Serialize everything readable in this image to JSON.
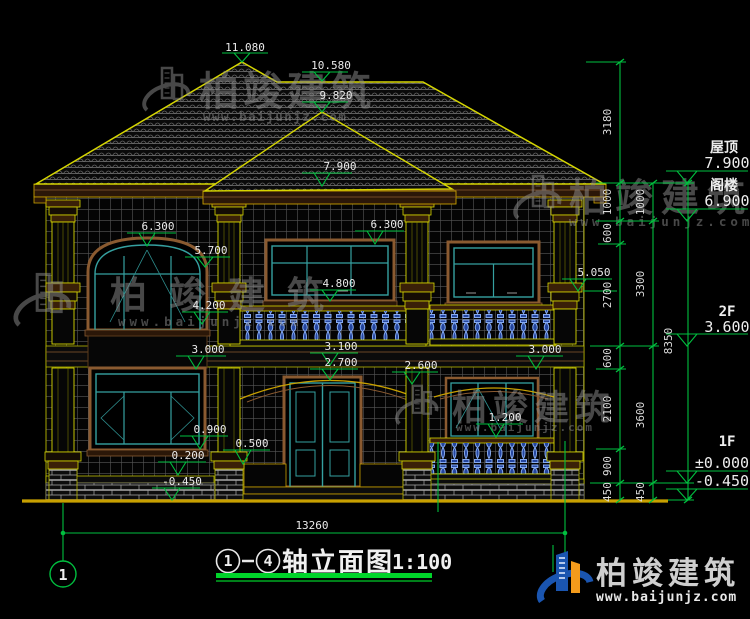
{
  "drawing": {
    "title": {
      "axis_start": "1",
      "axis_end": "4",
      "name": "轴立面图",
      "scale": "1:100"
    },
    "axis": {
      "left_bubble": "1"
    },
    "overall_width_dim": "13260",
    "elevation_markers": [
      "11.080",
      "10.580",
      "9.820",
      "7.900",
      "6.300",
      "5.700",
      "6.300",
      "4.800",
      "4.200",
      "3.000",
      "3.100",
      "2.700",
      "2.600",
      "3.000",
      "5.050",
      "1.200",
      "0.900",
      "0.500",
      "0.200",
      "-0.450"
    ],
    "dim_chains": {
      "inner": [
        "3180",
        "1000",
        "600",
        "2700",
        "600",
        "2100",
        "900",
        "450"
      ],
      "middle": [
        "1000",
        "3300",
        "3600",
        "450"
      ],
      "outer": [
        "8350"
      ]
    },
    "floor_levels": [
      {
        "label": "屋顶",
        "value": "7.900"
      },
      {
        "label": "阁楼",
        "value": "6.900"
      },
      {
        "label": "2F",
        "value": "3.600"
      },
      {
        "label": "1F",
        "value": "±0.000"
      },
      {
        "label": "",
        "value": "-0.450"
      }
    ]
  },
  "watermark": {
    "brand": "柏竣建筑",
    "url": "www.baijunjz.com"
  },
  "brand_logo": {
    "brand": "柏竣建筑",
    "url": "www.baijunjz.com"
  },
  "colors": {
    "dim_green": "#00bf3f",
    "cad_yellow": "#d6d600",
    "frame_teal": "#35a0a0",
    "frame_brown": "#8a5a30",
    "baluster_blue": "#4a7fd6",
    "logo_blue": "#1a55b0",
    "logo_orange": "#f49b1b"
  }
}
